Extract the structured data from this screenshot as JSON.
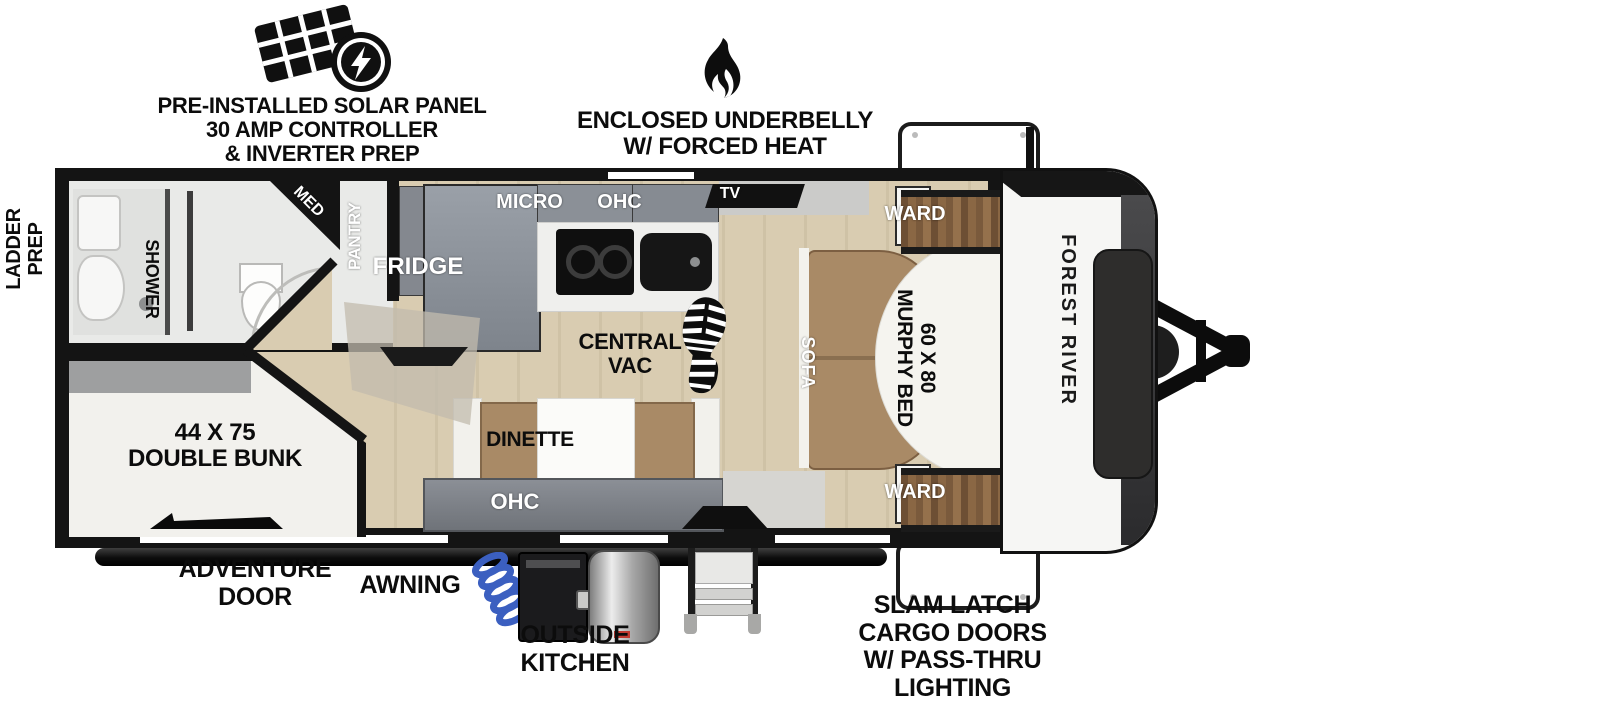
{
  "brand": {
    "name": "FOREST RIVER"
  },
  "exterior_callouts": {
    "solar": [
      "PRE-INSTALLED SOLAR PANEL",
      "30 AMP CONTROLLER",
      "& INVERTER PREP"
    ],
    "underbelly": [
      "ENCLOSED UNDERBELLY",
      "W/ FORCED HEAT"
    ],
    "ladder_prep": [
      "LADDER",
      "PREP"
    ],
    "adventure_door": [
      "ADVENTURE",
      "DOOR"
    ],
    "awning": "AWNING",
    "outside_kitchen": [
      "OUTSIDE",
      "KITCHEN"
    ],
    "cargo": [
      "SLAM LATCH",
      "CARGO DOORS",
      "W/ PASS-THRU",
      "LIGHTING"
    ]
  },
  "interior_labels": {
    "shower": "SHOWER",
    "med": "MED",
    "pantry": "PANTRY",
    "fridge": "FRIDGE",
    "micro": "MICRO",
    "ohc_kitchen": "OHC",
    "tv": "TV",
    "ward_top": "WARD",
    "ward_bottom": "WARD",
    "sofa": "SOFA",
    "murphy_bed": [
      "60 X 80",
      "MURPHY BED"
    ],
    "central_vac": [
      "CENTRAL",
      "VAC"
    ],
    "dinette": "DINETTE",
    "ohc_dinette": "OHC",
    "double_bunk": [
      "44 X 75",
      "DOUBLE BUNK"
    ]
  },
  "colors": {
    "wall": "#141414",
    "floor_tan": "#d9ccb1",
    "cabinet_gray": "#8b9097",
    "wood_brown": "#8a6744",
    "sofa_brown": "#a98a66",
    "hose_blue": "#3b5fc0",
    "bed_white": "#f5f4ef"
  }
}
